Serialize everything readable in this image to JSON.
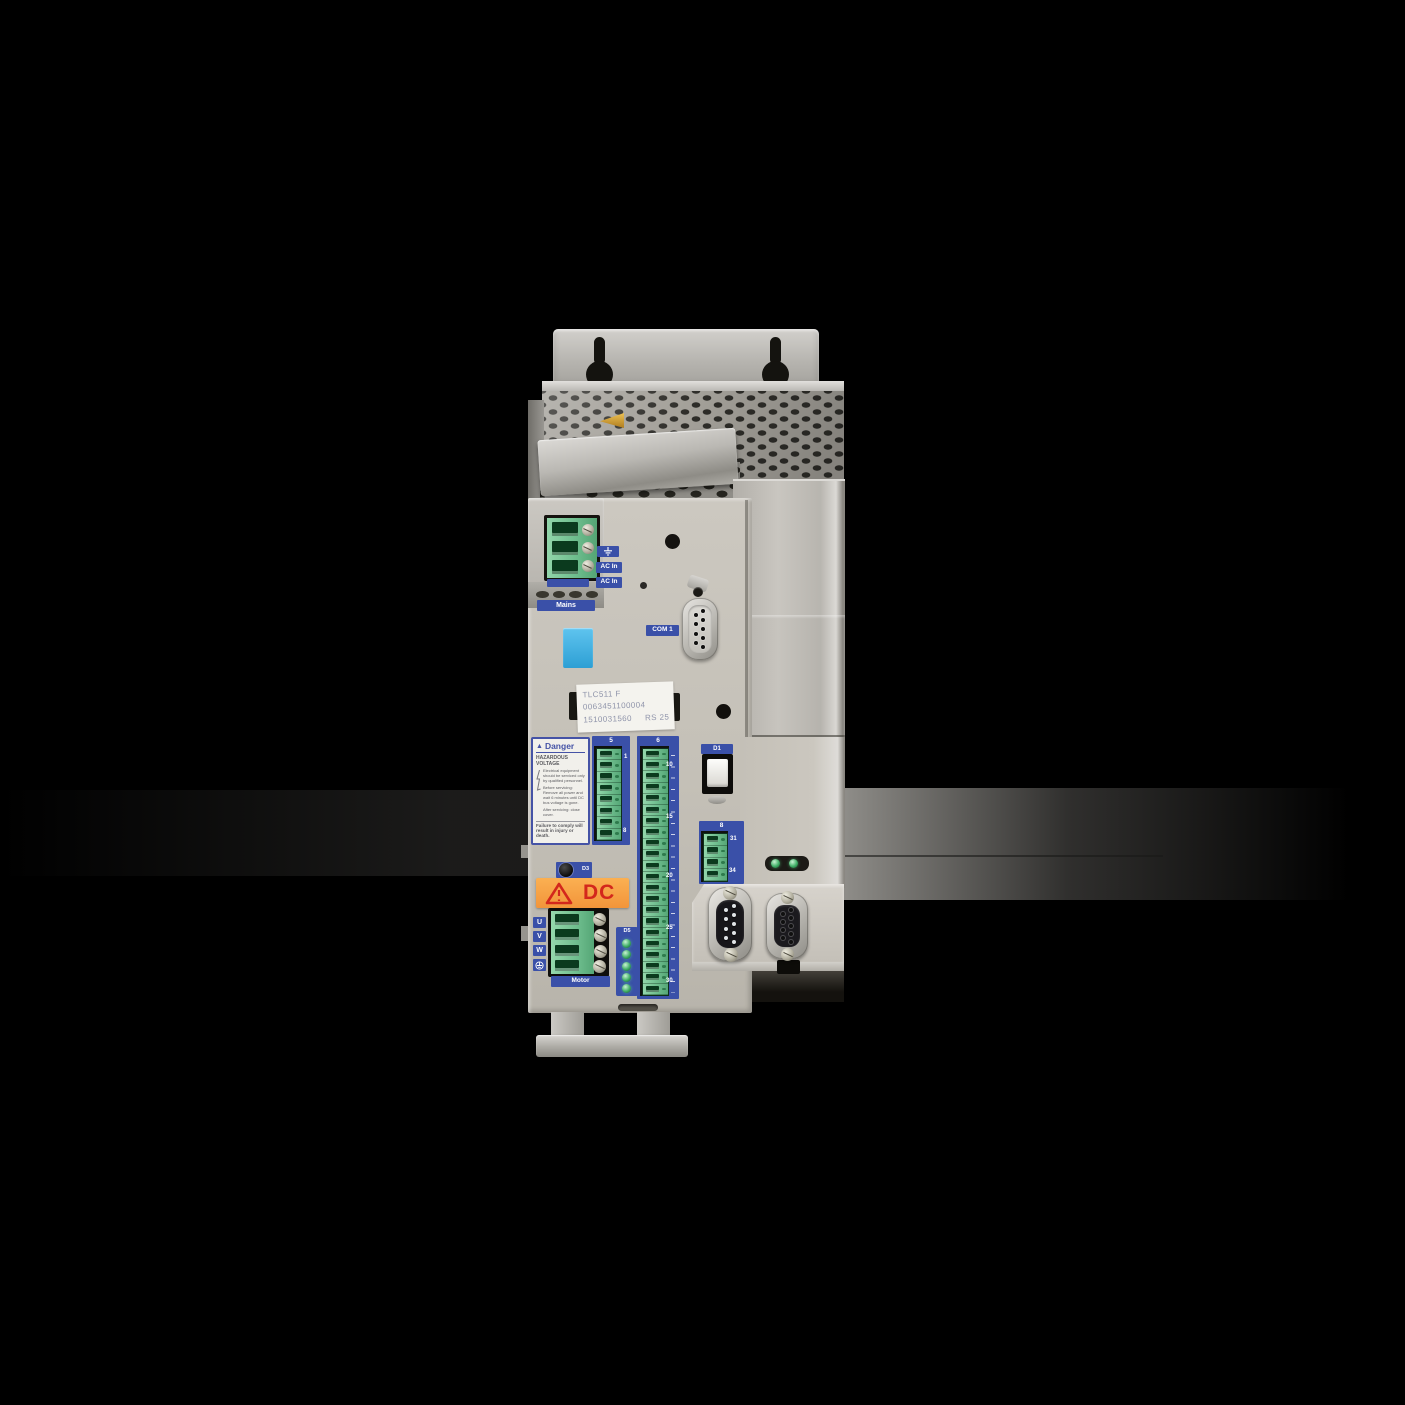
{
  "device": {
    "model": "TLC511 F",
    "power_in": {
      "ground_icon": "earth-ground-icon",
      "ac_in_top": "AC In",
      "ac_in_bottom": "AC In",
      "mains_label": "Mains"
    },
    "com1_label": "COM 1",
    "product_label": {
      "line1": "TLC511 F",
      "line2": "0063451100004",
      "line3": "1510031560     RS 25"
    },
    "danger_label": {
      "title": "Danger",
      "warning_icon": "warning-triangle-icon",
      "hazard": "HAZARDOUS VOLTAGE",
      "body": [
        "Electrical equipment should be serviced only by qualified personnel.",
        "Before servicing: Remove all power and wait 6 minutes until DC bus voltage is gone.",
        "After servicing: close cover."
      ],
      "footer": "Failure to comply will result in injury or death."
    },
    "connectors": {
      "conn5": {
        "header": "5",
        "first_pin": "1",
        "last_pin": "8",
        "pin_count": 8
      },
      "conn6": {
        "header": "6",
        "pin_count": 22,
        "markers": [
          "10",
          "15",
          "20",
          "25",
          "30"
        ]
      },
      "conn8": {
        "header": "8",
        "first_pin": "31",
        "last_pin": "34",
        "pin_count": 4
      }
    },
    "switch_d1_label": "D1",
    "button_d3_label": "D3",
    "led_d5": {
      "label": "D5",
      "led_count": 5
    },
    "status_leds": {
      "count": 2
    },
    "dc_sticker": {
      "warning_icon": "warning-triangle-icon",
      "text": "DC"
    },
    "motor": {
      "phases": [
        "U",
        "V",
        "W"
      ],
      "ground_icon": "earth-ground-icon",
      "label": "Motor",
      "terminal_count": 4
    },
    "ac_terminal_count": 3,
    "db9_cols": {
      "a": 5,
      "b": 4
    },
    "colors": {
      "label_blue": "#3a50a8",
      "connector_green": "#7cc79a",
      "sticker_orange": "#f8a540",
      "warning_red": "#d3281c",
      "cyan_button": "#3fb4e6",
      "led_green": "#3fae66",
      "body_beige": "#c6c2b9",
      "background": "#000000"
    }
  }
}
